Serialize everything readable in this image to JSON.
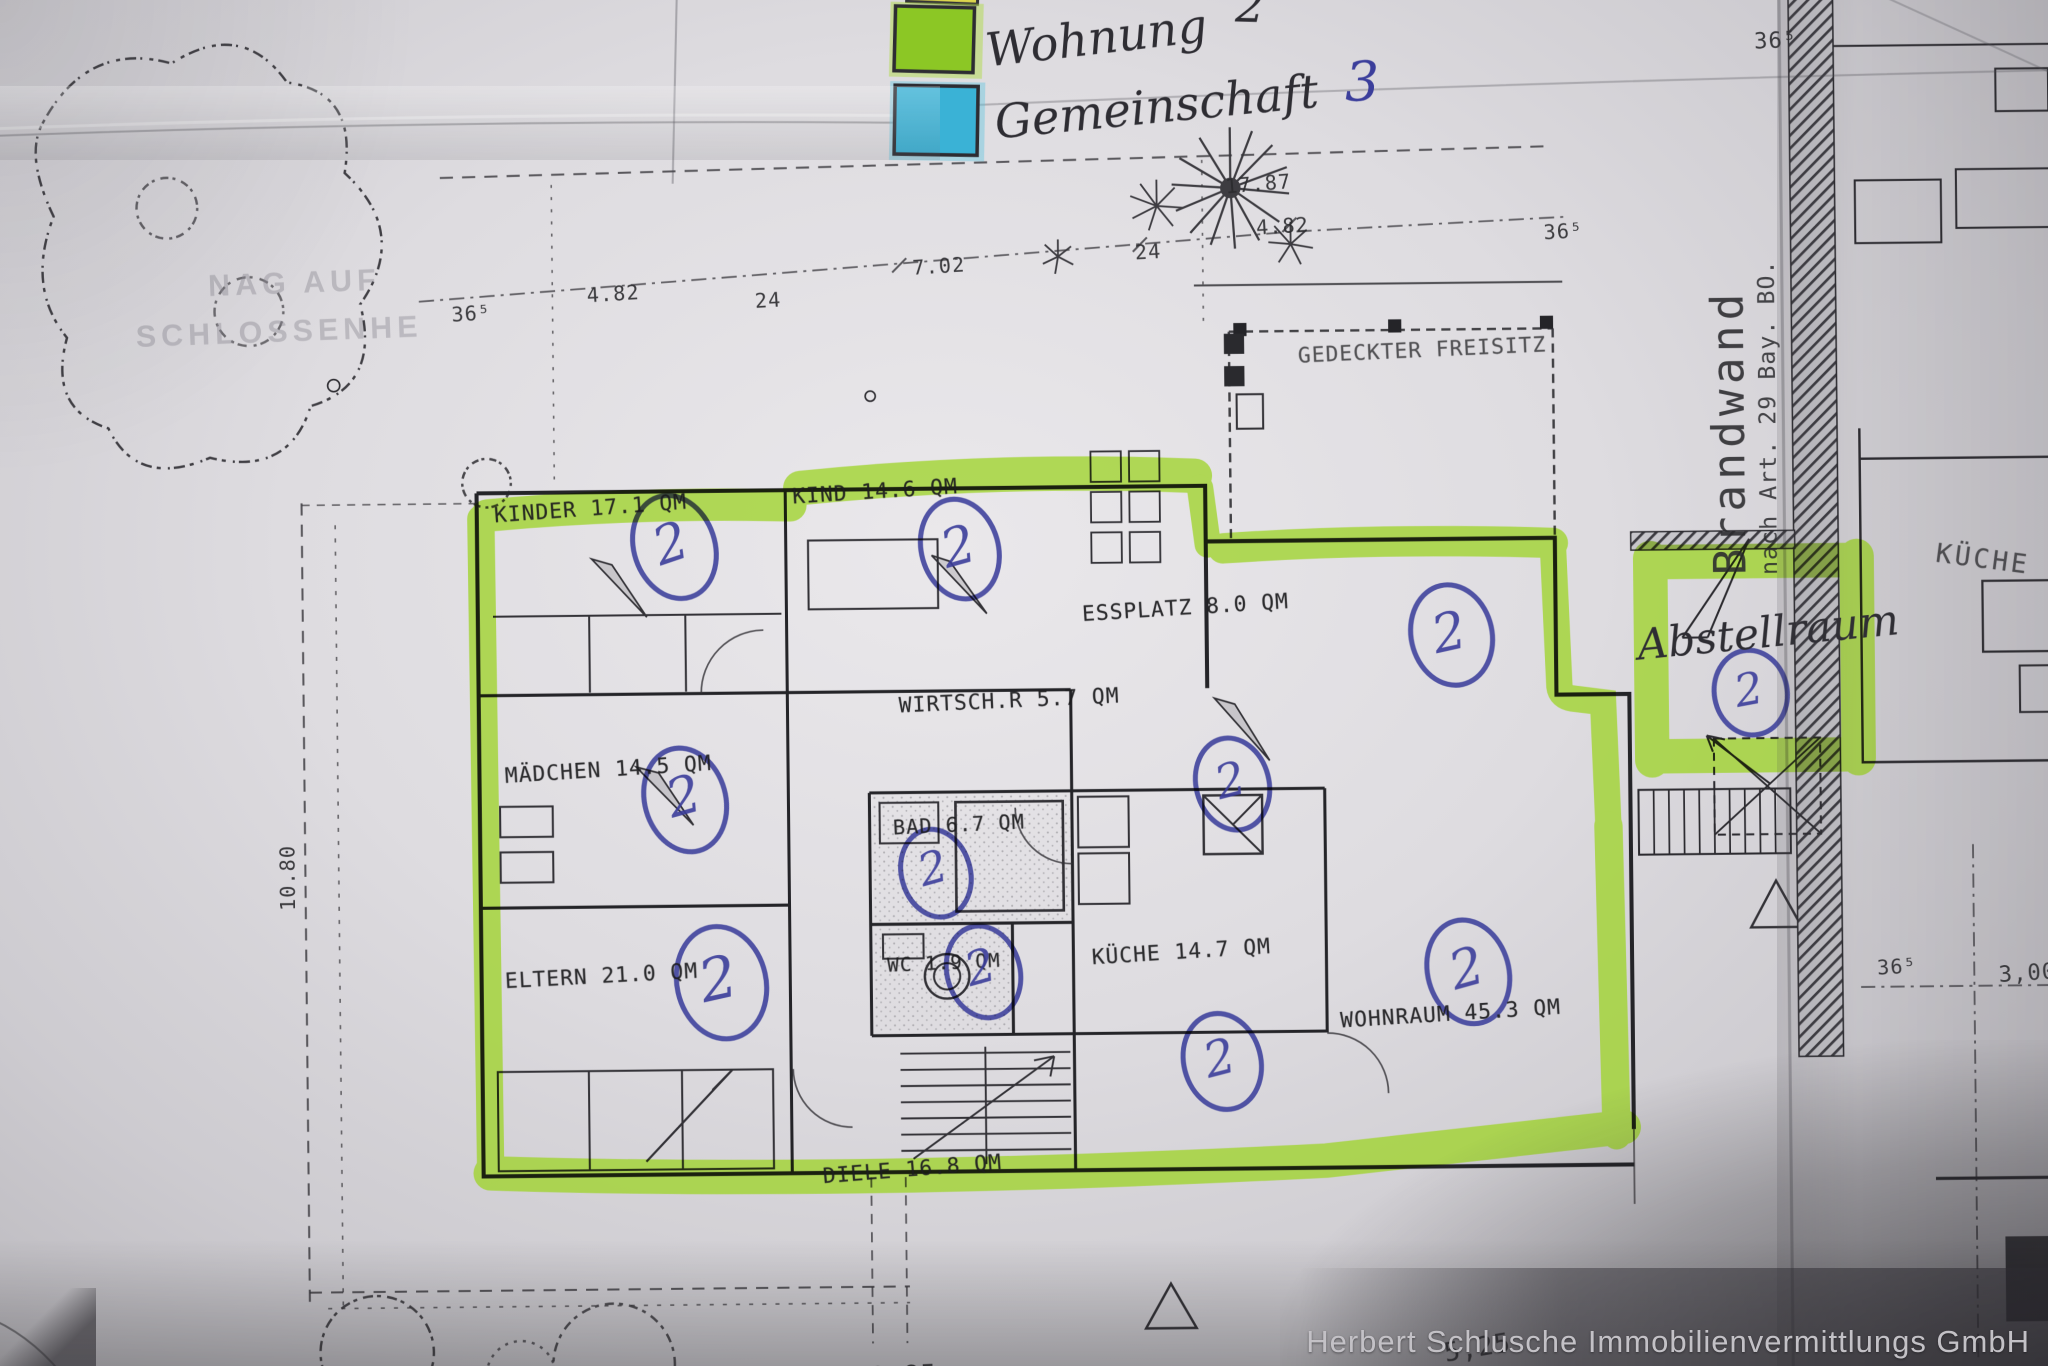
{
  "legend": {
    "items": [
      {
        "name": "wohnung",
        "label": "Wohnung",
        "count": "2",
        "swatch_color": "#8cc725"
      },
      {
        "name": "gemeinschaft",
        "label": "Gemeinschaft",
        "count": "3",
        "swatch_color": "#3ab2d6"
      }
    ],
    "partial_swatch_color": "#dcd64d"
  },
  "watermark_stamp": {
    "line1": "NAG AUF",
    "line2": "SCHLOSSENHE"
  },
  "rooms": [
    {
      "id": "kinder",
      "label": "KINDER 17.1 QM"
    },
    {
      "id": "kind",
      "label": "KIND 14.6 QM"
    },
    {
      "id": "essplatz",
      "label": "ESSPLATZ 8.0 QM"
    },
    {
      "id": "wirtschaftsraum",
      "label": "WIRTSCH.R 5.7 QM"
    },
    {
      "id": "maedchen",
      "label": "MÄDCHEN 14.5 QM"
    },
    {
      "id": "bad",
      "label": "BAD 6.7 QM"
    },
    {
      "id": "wc",
      "label": "WC 1.9 QM"
    },
    {
      "id": "kueche",
      "label": "KÜCHE 14.7 QM"
    },
    {
      "id": "eltern",
      "label": "ELTERN 21.0 QM"
    },
    {
      "id": "wohnraum",
      "label": "WOHNRAUM 45.3 QM"
    },
    {
      "id": "diele",
      "label": "DIELE 16.8 QM"
    },
    {
      "id": "freisitz",
      "label": "GEDECKTER FREISITZ"
    }
  ],
  "handwritten": {
    "abstellraum": "Abstellraum",
    "circled_number": "2"
  },
  "neighbor": {
    "kueche_label": "KÜCHE"
  },
  "firewall": {
    "title": "Brandwand",
    "subtitle": "nach Art. 29 Bay. BO."
  },
  "dimensions": {
    "d1787": "17.87",
    "d702": "7.02",
    "d24a": "24",
    "d482a": "4.82",
    "d365a": "36⁵",
    "d482b": "4.82",
    "d24b": "24",
    "d365b": "36⁵",
    "d365corner": "36⁵",
    "d365right": "36⁵",
    "d300": "3,00",
    "d1080": "10.80",
    "d525": "5,25",
    "d1085": "10.85"
  },
  "footer": {
    "brand": "Herbert Schlusche Immobilienvermittlungs GmbH"
  },
  "ink_colors": {
    "pen_blue": "#3b3e9b",
    "highlighter_green": "#9fd32b",
    "highlighter_cyan": "#3ab2d6"
  }
}
